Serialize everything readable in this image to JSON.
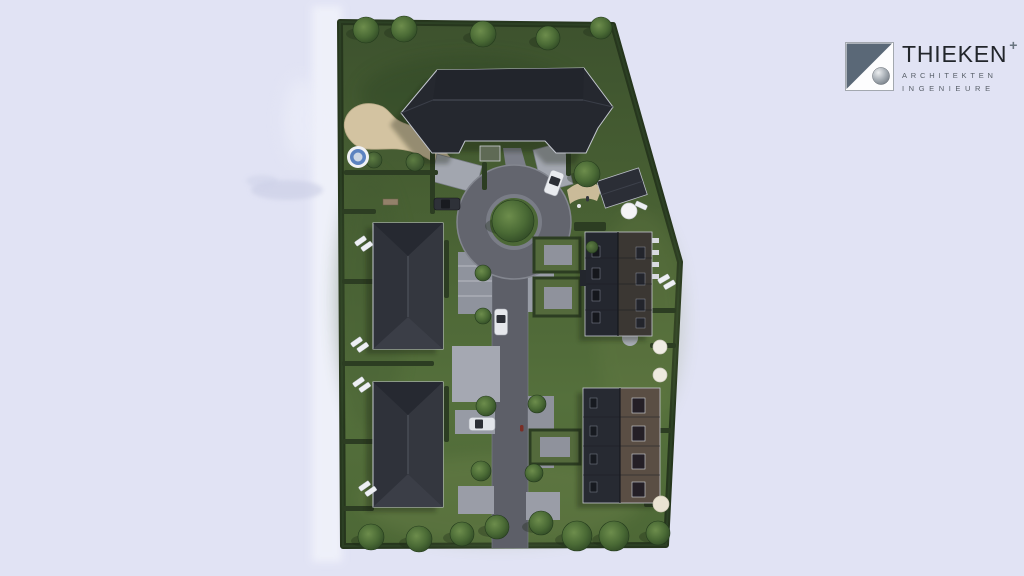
{
  "logo": {
    "brand": "THIEKEN",
    "plus": "+",
    "sub1": "ARCHITEKTEN",
    "sub2": "INGENIEURE"
  },
  "palette": {
    "background": "#e1e3f4",
    "cloud_highlight": "#f1f3fb",
    "lawn": "#4e6638",
    "hedge": "#2c3d22",
    "roof_dark": "#2a2d34",
    "roof_brown": "#5a4e44",
    "road": "#5e6069",
    "paving": "#9b9ea8",
    "sand": "#d2c2a0",
    "logo_slate": "#5a6877",
    "logo_text": "#22262b",
    "logo_subtext": "#575e67"
  },
  "scene": {
    "label": "aerial-site-plan-rendering",
    "buildings": [
      {
        "name": "main-building-north"
      },
      {
        "name": "apartment-west-upper"
      },
      {
        "name": "apartment-west-lower"
      },
      {
        "name": "rowhouse-east-upper"
      },
      {
        "name": "rowhouse-east-lower"
      },
      {
        "name": "garage-east"
      }
    ],
    "features": [
      "roundabout-with-tree",
      "central-access-road",
      "sand-play-area",
      "round-pool",
      "parking-bays",
      "garden-plots",
      "perimeter-hedge-with-trees"
    ],
    "vehicles": {
      "white_cars": 3,
      "dark_cars": 1
    },
    "people": 2
  }
}
